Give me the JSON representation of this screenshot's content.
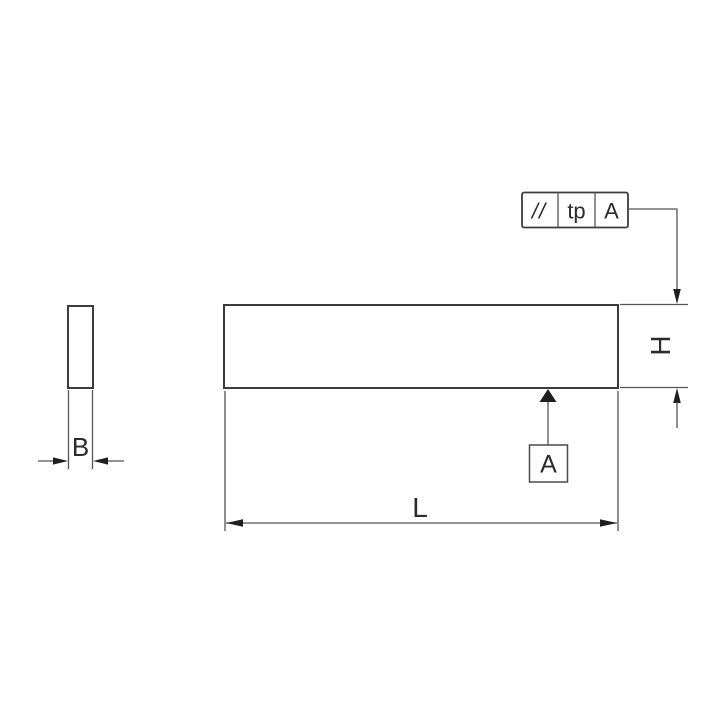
{
  "drawing": {
    "kind": "technical-dimension-drawing",
    "background": "#ffffff",
    "line_color": "#3c3c3c",
    "fill_color": "#1f1f1f",
    "text_color": "#2b2b2b"
  },
  "tolerance_frame": {
    "symbol": "//",
    "symbol_icon": "parallelism-icon",
    "value": "tp",
    "datum_ref": "A"
  },
  "dimensions": {
    "width_label": "B",
    "length_label": "L",
    "height_label": "H"
  },
  "datum_flag": {
    "label": "A"
  }
}
